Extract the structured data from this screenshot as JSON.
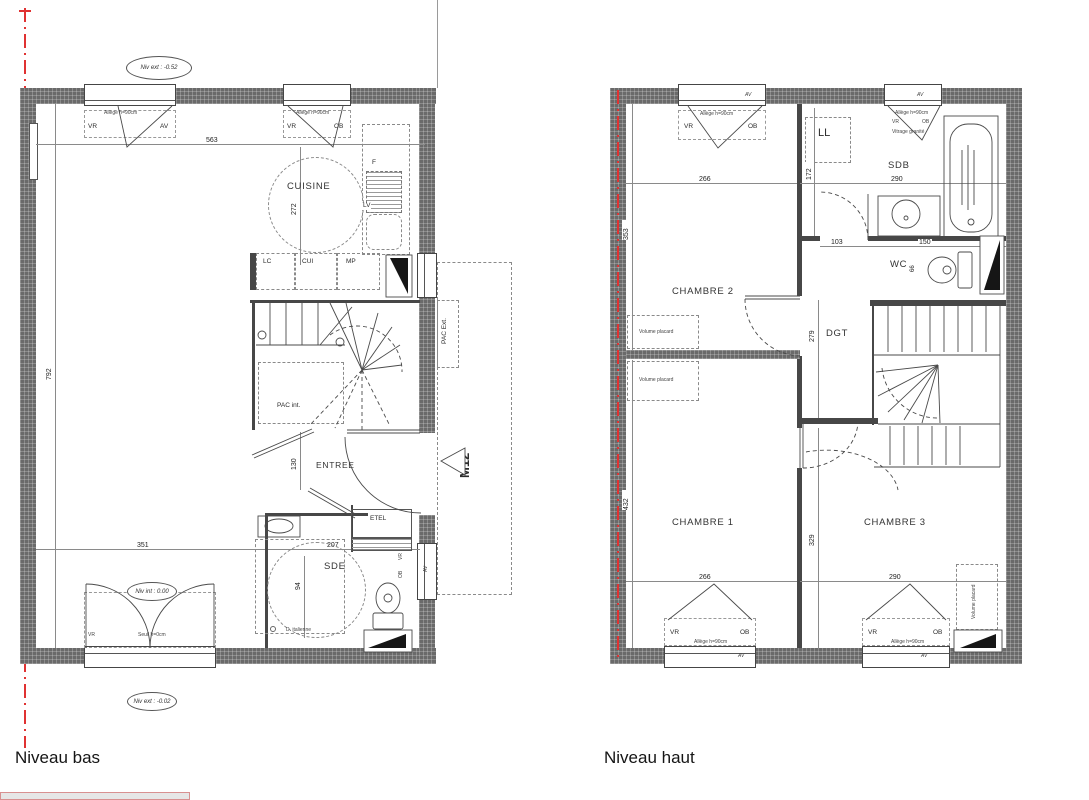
{
  "footer": {
    "niveau_bas": "Niveau bas",
    "niveau_haut": "Niveau haut"
  },
  "shared": {
    "vr": "VR",
    "av": "AV",
    "ob": "OB",
    "allege": "Allège h=90cm",
    "seuil": "Seuil h=0cm",
    "vitrage": "Vitrage granité",
    "volume_placard": "Volume placard"
  },
  "bas": {
    "rooms": {
      "cuisine": "CUISINE",
      "sejour": "SEJOUR",
      "entree": "ENTREE",
      "sde": "SDE"
    },
    "fixtures": {
      "f": "F",
      "lv": "LV",
      "lc": "LC",
      "cui": "CUI",
      "mp": "MP",
      "etel": "ETEL",
      "pac_int": "PAC int.",
      "pac_ext": "PAC Ext.",
      "douche": "D. italienne"
    },
    "levels": {
      "ext_top": "Niv ext : -0.52",
      "int_bottom": "Niv int : 0.00",
      "ext_bottom": "Niv ext : -0.02"
    },
    "marker": {
      "m12": "M12"
    },
    "dims": {
      "d563": "563",
      "d272": "272",
      "d792": "792",
      "d130": "130",
      "d351": "351",
      "d207": "207",
      "d94": "94"
    }
  },
  "haut": {
    "rooms": {
      "chambre1": "CHAMBRE 1",
      "chambre2": "CHAMBRE 2",
      "chambre3": "CHAMBRE 3",
      "sdb": "SDB",
      "wc": "WC",
      "dgt": "DGT",
      "ll": "LL"
    },
    "dims": {
      "d266t": "266",
      "d290t": "290",
      "d353": "353",
      "d172": "172",
      "d103": "103",
      "d150": "150",
      "d66": "66",
      "d279": "279",
      "d432": "432",
      "d329": "329",
      "d266b": "266",
      "d290b": "290"
    }
  },
  "colors": {
    "wall": "#6a6a6a",
    "line": "#474747",
    "property_line_red": "#e03232"
  }
}
